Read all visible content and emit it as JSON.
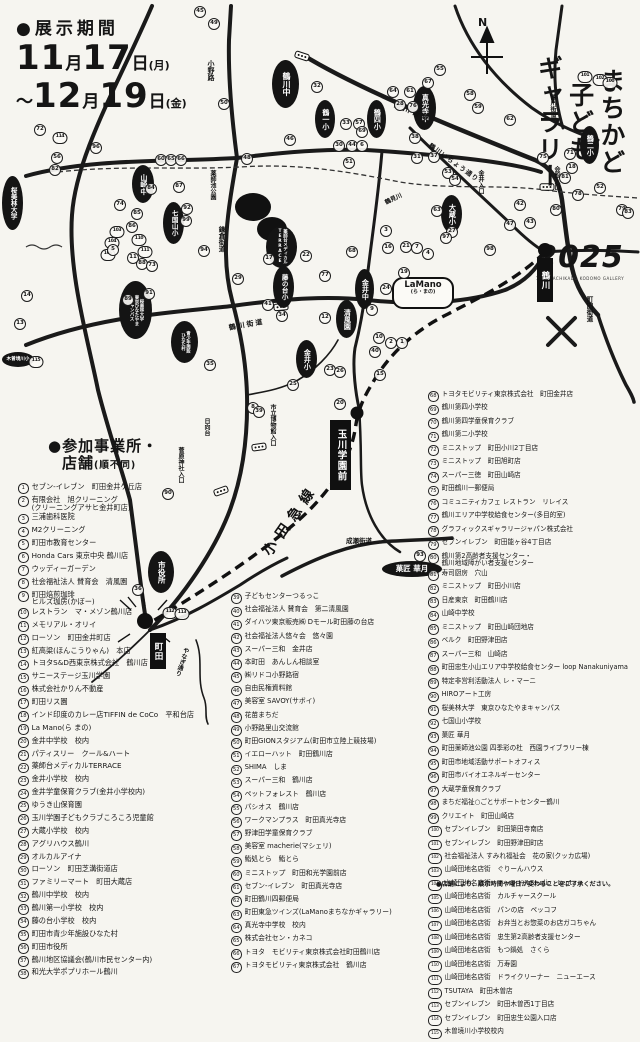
{
  "dates": {
    "label": "●展示期間",
    "line1": {
      "prefix": "",
      "month": "11",
      "day": "17",
      "dow": "(月)"
    },
    "line2": {
      "prefix": "～",
      "month": "12",
      "day": "19",
      "dow": "(金)"
    }
  },
  "title": {
    "text": "まちかど\n子ども\nギャラリー",
    "year": "2025",
    "caption": "18th MACHIKADO KODOMO GALLERY"
  },
  "map": {
    "compass_n": "N",
    "ink": "#151515",
    "ovals": [
      {
        "t": "鶴川中",
        "x": 272,
        "y": 60,
        "w": 27,
        "h": 48,
        "fs": 8
      },
      {
        "t": "鶴一小",
        "x": 315,
        "y": 100,
        "w": 20,
        "h": 38,
        "fs": 7
      },
      {
        "t": "鶴四小",
        "x": 367,
        "y": 100,
        "w": 19,
        "h": 38,
        "fs": 7
      },
      {
        "t": "真光寺中",
        "x": 413,
        "y": 86,
        "w": 23,
        "h": 44,
        "fs": 7
      },
      {
        "t": "大蔵小",
        "x": 441,
        "y": 195,
        "w": 21,
        "h": 38,
        "fs": 7
      },
      {
        "t": "鶴二小",
        "x": 580,
        "y": 126,
        "w": 19,
        "h": 38,
        "fs": 7
      },
      {
        "t": "山崎中",
        "x": 132,
        "y": 165,
        "w": 22,
        "h": 38,
        "fs": 7
      },
      {
        "t": "七国山小",
        "x": 163,
        "y": 202,
        "w": 21,
        "h": 42,
        "fs": 6.5
      },
      {
        "t": "桜美林大学",
        "x": 2,
        "y": 176,
        "w": 21,
        "h": 54,
        "fs": 6.5
      },
      {
        "t": "藤の台小",
        "x": 273,
        "y": 266,
        "w": 21,
        "h": 42,
        "fs": 6.5
      },
      {
        "t": "金井中",
        "x": 355,
        "y": 269,
        "w": 19,
        "h": 40,
        "fs": 7
      },
      {
        "t": "清風園",
        "x": 336,
        "y": 300,
        "w": 21,
        "h": 38,
        "fs": 7
      },
      {
        "t": "金井小",
        "x": 296,
        "y": 340,
        "w": 21,
        "h": 38,
        "fs": 7
      },
      {
        "t": "薬師台メディカル\nTERRACE",
        "x": 266,
        "y": 226,
        "w": 31,
        "h": 42,
        "fs": 4.4
      },
      {
        "t": "桜美林大学\n東京ひなたやま\nキャンパス",
        "x": 119,
        "y": 281,
        "w": 33,
        "h": 58,
        "fs": 4.4
      },
      {
        "t": "青少年施設\nひなた村",
        "x": 171,
        "y": 321,
        "w": 27,
        "h": 42,
        "fs": 4.4
      },
      {
        "t": "市役所",
        "x": 148,
        "y": 551,
        "w": 26,
        "h": 42,
        "fs": 7.5
      },
      {
        "t": "木曽境川小",
        "x": 2,
        "y": 352,
        "w": 32,
        "h": 15,
        "fs": 4.6,
        "horiz": true
      },
      {
        "t": "菓匠 華月",
        "x": 382,
        "y": 561,
        "w": 60,
        "h": 16,
        "fs": 7.5,
        "horiz": true
      }
    ],
    "bubble": {
      "t": "LaMano",
      "sub": "(ら・まの)",
      "x": 392,
      "y": 277,
      "w": 52,
      "h": 24,
      "fs": 8.5
    },
    "stations": [
      {
        "t": "鶴川",
        "dx": 545,
        "dy": 250,
        "ds": 14,
        "bx": 537,
        "by": 258,
        "bw": 16,
        "bh": 44,
        "fs": 8.5
      },
      {
        "t": "玉川学園前",
        "dx": 357,
        "dy": 413,
        "ds": 13,
        "bx": 330,
        "by": 420,
        "bw": 21,
        "bh": 70,
        "fs": 9.5
      },
      {
        "t": "町田",
        "dx": 145,
        "dy": 621,
        "ds": 16,
        "bx": 150,
        "by": 633,
        "bw": 16,
        "bh": 36,
        "fs": 8.5
      }
    ],
    "roadLabels": [
      {
        "t": "小野路",
        "x": 206,
        "y": 60,
        "fs": 7,
        "vert": true
      },
      {
        "t": "鶴川街道",
        "x": 396,
        "y": 100,
        "fs": 7,
        "rot": 22,
        "ls": 3
      },
      {
        "t": "鶴川街道",
        "x": 548,
        "y": 94,
        "fs": 6,
        "vert": true
      },
      {
        "t": "鶴川いちょう通り",
        "x": 433,
        "y": 140,
        "fs": 6.5,
        "rot": 36,
        "ls": 1
      },
      {
        "t": "会館入口",
        "x": 552,
        "y": 166,
        "fs": 6,
        "vert": true
      },
      {
        "t": "金井入口",
        "x": 476,
        "y": 170,
        "fs": 6,
        "vert": true
      },
      {
        "t": "鎌倉街道",
        "x": 216,
        "y": 226,
        "fs": 6.5,
        "vert": true
      },
      {
        "t": "薬師池公園",
        "x": 208,
        "y": 170,
        "fs": 6,
        "vert": true
      },
      {
        "t": "鶴見川",
        "x": 383,
        "y": 198,
        "fs": 6,
        "rot": -25
      },
      {
        "t": "鶴川街道",
        "x": 228,
        "y": 323,
        "fs": 7,
        "rot": -10,
        "ls": 2
      },
      {
        "t": "日向台",
        "x": 202,
        "y": 418,
        "fs": 6,
        "vert": true
      },
      {
        "t": "市立博物館入口",
        "x": 268,
        "y": 404,
        "fs": 6,
        "vert": true
      },
      {
        "t": "菅原神社入口",
        "x": 176,
        "y": 447,
        "fs": 6,
        "vert": true
      },
      {
        "t": "小田急線",
        "x": 258,
        "y": 548,
        "fs": 14,
        "rot": -55,
        "ls": 7,
        "b": true
      },
      {
        "t": "成瀬街道",
        "x": 346,
        "y": 535,
        "fs": 6.5
      },
      {
        "t": "町田街道",
        "x": 584,
        "y": 296,
        "fs": 6.5,
        "vert": true
      },
      {
        "t": "やなぎ通り",
        "x": 182,
        "y": 646,
        "fs": 6,
        "vert": true,
        "rot": 18
      }
    ],
    "circles": [
      [
        45,
        200,
        12
      ],
      [
        49,
        214,
        24
      ],
      [
        50,
        224,
        104
      ],
      [
        46,
        290,
        140
      ],
      [
        32,
        317,
        87
      ],
      [
        33,
        346,
        124
      ],
      [
        57,
        359,
        124
      ],
      [
        30,
        339,
        146
      ],
      [
        44,
        352,
        146
      ],
      [
        6,
        362,
        146
      ],
      [
        48,
        247,
        159
      ],
      [
        51,
        349,
        163
      ],
      [
        60,
        161,
        160
      ],
      [
        65,
        171,
        160
      ],
      [
        66,
        181,
        160
      ],
      [
        56,
        57,
        158
      ],
      [
        82,
        55,
        170
      ],
      [
        72,
        40,
        130
      ],
      [
        114,
        60,
        138
      ],
      [
        96,
        96,
        148
      ],
      [
        84,
        151,
        189
      ],
      [
        87,
        179,
        187
      ],
      [
        74,
        120,
        205
      ],
      [
        85,
        137,
        214
      ],
      [
        86,
        132,
        227
      ],
      [
        103,
        117,
        232
      ],
      [
        104,
        112,
        243
      ],
      [
        110,
        139,
        240
      ],
      [
        111,
        145,
        252
      ],
      [
        106,
        108,
        255
      ],
      [
        88,
        142,
        264
      ],
      [
        89,
        128,
        300
      ],
      [
        92,
        187,
        209
      ],
      [
        99,
        186,
        221
      ],
      [
        94,
        204,
        251
      ],
      [
        91,
        149,
        294
      ],
      [
        5,
        113,
        250
      ],
      [
        11,
        133,
        258
      ],
      [
        73,
        152,
        266
      ],
      [
        13,
        20,
        324
      ],
      [
        14,
        27,
        296
      ],
      [
        115,
        36,
        362
      ],
      [
        55,
        440,
        70
      ],
      [
        67,
        428,
        83
      ],
      [
        64,
        393,
        92
      ],
      [
        61,
        410,
        92
      ],
      [
        58,
        470,
        95
      ],
      [
        59,
        478,
        108
      ],
      [
        62,
        510,
        120
      ],
      [
        28,
        400,
        105
      ],
      [
        76,
        413,
        107
      ],
      [
        38,
        415,
        138
      ],
      [
        31,
        417,
        158
      ],
      [
        37,
        434,
        157
      ],
      [
        53,
        448,
        173
      ],
      [
        54,
        455,
        180
      ],
      [
        75,
        543,
        158
      ],
      [
        71,
        570,
        154
      ],
      [
        18,
        572,
        168
      ],
      [
        81,
        565,
        178
      ],
      [
        78,
        578,
        195
      ],
      [
        52,
        600,
        188
      ],
      [
        80,
        556,
        210
      ],
      [
        79,
        622,
        210
      ],
      [
        83,
        628,
        213
      ],
      [
        63,
        437,
        211
      ],
      [
        47,
        510,
        225
      ],
      [
        43,
        530,
        223
      ],
      [
        42,
        520,
        205
      ],
      [
        98,
        490,
        250
      ],
      [
        101,
        585,
        77
      ],
      [
        102,
        600,
        80
      ],
      [
        100,
        610,
        83
      ],
      [
        17,
        269,
        259
      ],
      [
        22,
        306,
        256
      ],
      [
        29,
        238,
        279
      ],
      [
        41,
        268,
        305
      ],
      [
        77,
        325,
        276
      ],
      [
        12,
        325,
        318
      ],
      [
        16,
        388,
        248
      ],
      [
        21,
        406,
        247
      ],
      [
        7,
        417,
        248
      ],
      [
        4,
        428,
        254
      ],
      [
        3,
        386,
        231
      ],
      [
        19,
        404,
        273
      ],
      [
        24,
        386,
        289
      ],
      [
        68,
        352,
        252
      ],
      [
        9,
        372,
        310
      ],
      [
        2,
        391,
        343
      ],
      [
        1,
        402,
        343
      ],
      [
        10,
        379,
        338
      ],
      [
        40,
        375,
        352
      ],
      [
        15,
        380,
        375
      ],
      [
        23,
        330,
        370
      ],
      [
        26,
        340,
        372
      ],
      [
        25,
        293,
        385
      ],
      [
        8,
        253,
        408
      ],
      [
        39,
        259,
        412
      ],
      [
        34,
        282,
        316
      ],
      [
        27,
        452,
        232
      ],
      [
        97,
        446,
        238
      ],
      [
        35,
        210,
        365
      ],
      [
        90,
        168,
        494
      ],
      [
        20,
        340,
        404
      ],
      [
        36,
        138,
        590
      ],
      [
        112,
        170,
        613
      ],
      [
        113,
        182,
        614
      ],
      [
        93,
        420,
        556
      ],
      [
        69,
        362,
        132
      ]
    ]
  },
  "lists": {
    "heading1": "●参加事業所・",
    "heading2_main": "店舗",
    "heading2_suffix": "(順不同)",
    "footnote": "●店舗により、展示時間や曜日が変わることをご了承ください。",
    "columns": [
      {
        "items": [
          [
            1,
            "セブン-イレブン　町田金井ケ丘店"
          ],
          [
            2,
            "有限会社　旭クリーニング\n(クリーニングアサヒ金井町店)"
          ],
          [
            3,
            "三浦歯科医院"
          ],
          [
            4,
            "M2クリーニング"
          ],
          [
            5,
            "町田市教育センター"
          ],
          [
            6,
            "Honda Cars 東京中央 鶴川店"
          ],
          [
            7,
            "ウッディーガーデン"
          ],
          [
            8,
            "社会福祉法人 賛育会　清風園"
          ],
          [
            9,
            "町田焙煎珈琲\nヒルズ珈房(かぼー)"
          ],
          [
            10,
            "レストラン　マ・メゾン鶴川店"
          ],
          [
            11,
            "メモリアル・オリイ"
          ],
          [
            12,
            "ローソン　町田金井町店"
          ],
          [
            13,
            "紅高粱(ほんこうりゃん)　本店"
          ],
          [
            14,
            "トヨタS&D西東京株式会社　鶴川店"
          ],
          [
            15,
            "サニーステージ玉川学園"
          ],
          [
            16,
            "株式会社かりん不動産"
          ],
          [
            17,
            "町田リス園"
          ],
          [
            18,
            "インド印度のカレー店TIFFIN de CoCo　平和台店"
          ],
          [
            19,
            "La Mano(ら まの)"
          ],
          [
            20,
            "金井中学校　校内"
          ],
          [
            21,
            "パティスリー　クール&ハート"
          ],
          [
            22,
            "薬師台メディカルTERRACE"
          ],
          [
            23,
            "金井小学校　校内"
          ],
          [
            24,
            "金井学童保育クラブ(金井小学校内)"
          ],
          [
            25,
            "ゆうき山保育園"
          ],
          [
            26,
            "玉川学園子どもクラブころころ児童館"
          ],
          [
            27,
            "大蔵小学校　校内"
          ],
          [
            28,
            "アグリハウス鶴川"
          ],
          [
            29,
            "オルカルアイナ"
          ],
          [
            30,
            "ローソン　町田芝溝街道店"
          ],
          [
            31,
            "ファミリーマート　町田大蔵店"
          ],
          [
            32,
            "鶴川中学校　校内"
          ],
          [
            33,
            "鶴川第一小学校　校内"
          ],
          [
            34,
            "藤の台小学校　校内"
          ],
          [
            35,
            "町田市青少年施設ひなた村"
          ],
          [
            36,
            "町田市役所"
          ],
          [
            37,
            "鶴川地区協議会(鶴川市民センター内)"
          ],
          [
            38,
            "和光大学ポプリホール鶴川"
          ]
        ]
      },
      {
        "items": [
          [
            39,
            "子どもセンターつるっこ"
          ],
          [
            40,
            "社会福祉法人 賛育会　第二清風園"
          ],
          [
            41,
            "ダイハツ東京販売㈱ Dモール町田藤の台店"
          ],
          [
            42,
            "社会福祉法人悠々会　悠々園"
          ],
          [
            43,
            "スーパー三和　金井店"
          ],
          [
            44,
            "本町田　あんしん相談室"
          ],
          [
            45,
            "㈱リドコ小野路宿"
          ],
          [
            46,
            "自由民権資料館"
          ],
          [
            47,
            "美容室 SAVOY(サボイ)"
          ],
          [
            48,
            "花苗まちだ"
          ],
          [
            49,
            "小野路里山交流館"
          ],
          [
            50,
            "町田GIONスタジアム(町田市立陸上競技場)"
          ],
          [
            51,
            "イエローハット　町田鶴川店"
          ],
          [
            52,
            "SHIMA　しま"
          ],
          [
            53,
            "スーパー三和　鶴川店"
          ],
          [
            54,
            "ペットフォレスト　鶴川店"
          ],
          [
            55,
            "パシオス　鶴川店"
          ],
          [
            56,
            "ワークマンプラス　町田真光寺店"
          ],
          [
            57,
            "野津田学童保育クラブ"
          ],
          [
            58,
            "美容室 macherie(マシェリ)"
          ],
          [
            59,
            "鮨処とら　鮨とら"
          ],
          [
            60,
            "ミニストップ　町田和光学園前店"
          ],
          [
            61,
            "セブン-イレブン　町田真光寺店"
          ],
          [
            62,
            "町田鶴川四郵便局"
          ],
          [
            63,
            "町田東急ツインズ(LaManoまちなかギャラリー)"
          ],
          [
            64,
            "真光寺中学校　校内"
          ],
          [
            65,
            "株式会社セン・カネコ"
          ],
          [
            66,
            "トヨタ　モビリティ東京株式会社町田鶴川店"
          ],
          [
            67,
            "トヨタモビリティ東京株式会社　鶴川店"
          ]
        ]
      },
      {
        "items": [
          [
            68,
            "トヨタモビリティ東京株式会社　町田金井店"
          ],
          [
            69,
            "鶴川第四小学校"
          ],
          [
            70,
            "鶴川第四学童保育クラブ"
          ],
          [
            71,
            "鶴川第二小学校"
          ],
          [
            72,
            "ミニストップ　町田小川2丁目店"
          ],
          [
            73,
            "ミニストップ　町田旭町店"
          ],
          [
            74,
            "スーパー三徳　町田山崎店"
          ],
          [
            75,
            "町田鶴川一郵便局"
          ],
          [
            76,
            "コミュニティカフェ レストラン　リレイス"
          ],
          [
            77,
            "鶴川エリア中学校給食センター(多目的室)"
          ],
          [
            78,
            "グラフィックスギャラリージャパン株式会社"
          ],
          [
            79,
            "セブンイレブン　町田能ヶ谷4丁目店"
          ],
          [
            80,
            "鶴川第2高齢者支援センター・\n鶴川地域障がい者支援センター"
          ],
          [
            81,
            "寿司厨房　穴山"
          ],
          [
            82,
            "ミニストップ　町田小川店"
          ],
          [
            83,
            "日産東京　町田鶴川店"
          ],
          [
            84,
            "山崎中学校"
          ],
          [
            85,
            "ミニストップ　町田山崎団地店"
          ],
          [
            86,
            "ベルク　町田野津田店"
          ],
          [
            87,
            "スーパー三和　山崎店"
          ],
          [
            88,
            "町田忠生小山エリア中学校給食センター loop Nanakuniyama"
          ],
          [
            89,
            "特定非営利活動法人 レ・マーニ"
          ],
          [
            90,
            "HIROアート工房"
          ],
          [
            91,
            "桜美林大学　東京ひなたやまキャンパス"
          ],
          [
            92,
            "七国山小学校"
          ],
          [
            93,
            "菓匠 華月"
          ],
          [
            94,
            "町田薬師池公園 四季彩の杜　西園ライブラリー棟"
          ],
          [
            95,
            "町田市地域活動サポートオフィス"
          ],
          [
            96,
            "町田市バイオエネルギーセンター"
          ],
          [
            97,
            "大蔵学童保育クラブ"
          ],
          [
            98,
            "まちだ福祉○ごとサポートセンター鶴川"
          ],
          [
            99,
            "クリエイト　町田山崎店"
          ],
          [
            100,
            "セブンイレブン　町田簗田寺南店"
          ],
          [
            101,
            "セブンイレブン　町田野津田町店"
          ],
          [
            102,
            "社会福祉法人 すみれ福祉会　花の家(クッカ広場)"
          ],
          [
            103,
            "山崎団地名店街　ぐりーんハウス"
          ],
          [
            104,
            "山崎団地名店街　キャンドルStudio　Lepta"
          ],
          [
            105,
            "山崎団地名店街　カルチャースクール"
          ],
          [
            106,
            "山崎団地名店街　パンの店　ペッコフ"
          ],
          [
            107,
            "山崎団地名店街　お弁当とお惣菜のお店ガコちゃん"
          ],
          [
            108,
            "山崎団地名店街　忠生第2高齢者支援センター"
          ],
          [
            109,
            "山崎団地名店街　もつ鍋処　さくら"
          ],
          [
            110,
            "山崎団地名店街　万寿園"
          ],
          [
            111,
            "山崎団地名店街　ドライクリーナー　ニューエース"
          ],
          [
            112,
            "TSUTAYA　町田木曽店"
          ],
          [
            113,
            "セブンイレブン　町田木曽西1丁目店"
          ],
          [
            114,
            "セブンイレブン　町田忠生公園入口店"
          ],
          [
            115,
            "木曽境川小学校校内"
          ]
        ]
      }
    ]
  }
}
